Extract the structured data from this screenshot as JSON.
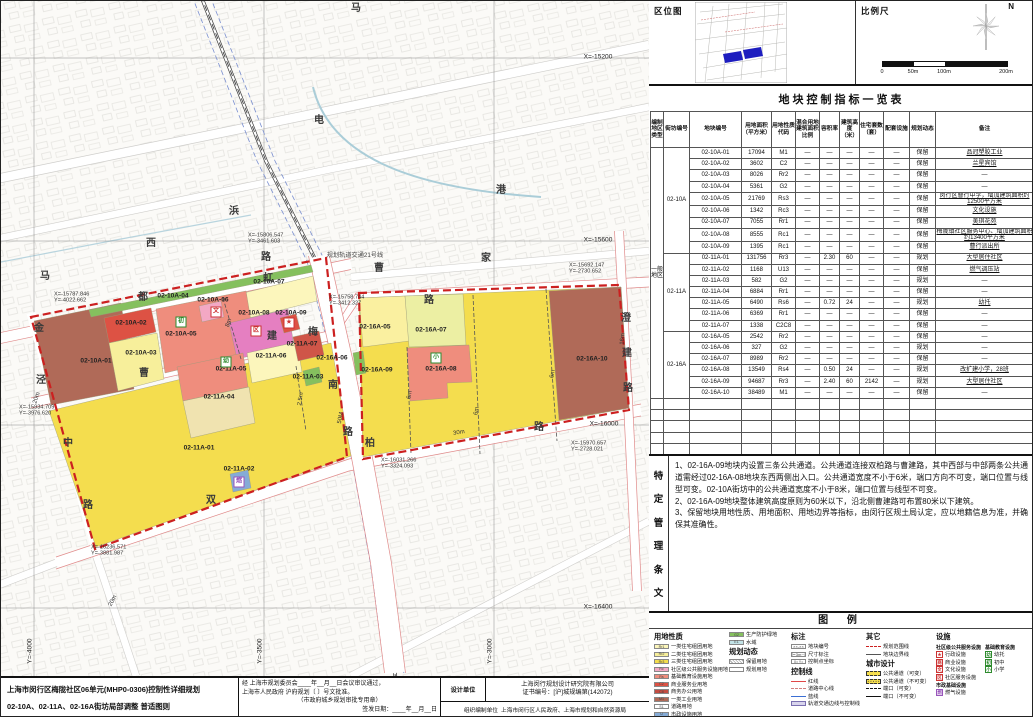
{
  "location_panel": {
    "title": "区位图"
  },
  "scale_panel": {
    "title": "比例尺",
    "north_label": "N",
    "ticks": [
      "0",
      "50m",
      "100m",
      "200m"
    ]
  },
  "table": {
    "title": "地块控制指标一览表",
    "headers": [
      "编制地区类型",
      "街坊编号",
      "地块编号",
      "用地面积（平方米）",
      "用地性质代码",
      "混合用地建筑面积比例",
      "容积率",
      "建筑高度（米）",
      "住宅套数（套）",
      "配套设施",
      "规划动态",
      "备注"
    ],
    "area_type": "一般地区",
    "groups": [
      {
        "block": "02-10A",
        "rows": [
          [
            "02-10A-01",
            "17094",
            "M1",
            "—",
            "—",
            "—",
            "—",
            "—",
            "保留",
            "品冠塑胶工业"
          ],
          [
            "02-10A-02",
            "3602",
            "C2",
            "—",
            "—",
            "—",
            "—",
            "—",
            "保留",
            "兰星宾馆"
          ],
          [
            "02-10A-03",
            "8026",
            "Rr2",
            "—",
            "—",
            "—",
            "—",
            "—",
            "保留",
            "—"
          ],
          [
            "02-10A-04",
            "5361",
            "G2",
            "—",
            "—",
            "—",
            "—",
            "—",
            "保留",
            "—"
          ],
          [
            "02-10A-05",
            "21769",
            "Rs3",
            "—",
            "—",
            "—",
            "—",
            "—",
            "保留",
            "闵行区曹行中学，增加建筑面积约12500平方米"
          ],
          [
            "02-10A-06",
            "1342",
            "Rc3",
            "—",
            "—",
            "—",
            "—",
            "—",
            "保留",
            "文化设施"
          ],
          [
            "02-10A-07",
            "7055",
            "Rr1",
            "—",
            "—",
            "—",
            "—",
            "—",
            "保留",
            "美琪花苑"
          ],
          [
            "02-10A-08",
            "8555",
            "Rc1",
            "—",
            "—",
            "—",
            "—",
            "—",
            "保留",
            "梅陇镇社区服务中心、增加建筑面积约13400平方米"
          ],
          [
            "02-10A-09",
            "1395",
            "Rc1",
            "—",
            "—",
            "—",
            "—",
            "—",
            "保留",
            "曹行派出所"
          ]
        ]
      },
      {
        "block": "02-11A",
        "rows": [
          [
            "02-11A-01",
            "131756",
            "Rr3",
            "—",
            "2.30",
            "60",
            "—",
            "—",
            "规划",
            "大型居住社区"
          ],
          [
            "02-11A-02",
            "1168",
            "U13",
            "—",
            "—",
            "—",
            "—",
            "—",
            "保留",
            "燃气调压站"
          ],
          [
            "02-11A-03",
            "582",
            "G2",
            "—",
            "—",
            "—",
            "—",
            "—",
            "规划",
            "—"
          ],
          [
            "02-11A-04",
            "6884",
            "Rr1",
            "—",
            "—",
            "—",
            "—",
            "—",
            "保留",
            "—"
          ],
          [
            "02-11A-05",
            "6490",
            "Rs6",
            "—",
            "0.72",
            "24",
            "—",
            "—",
            "规划",
            "幼托"
          ],
          [
            "02-11A-06",
            "6369",
            "Rr1",
            "—",
            "—",
            "—",
            "—",
            "—",
            "保留",
            "—"
          ],
          [
            "02-11A-07",
            "1338",
            "C2C8",
            "—",
            "—",
            "—",
            "—",
            "—",
            "保留",
            "—"
          ]
        ]
      },
      {
        "block": "02-16A",
        "rows": [
          [
            "02-16A-05",
            "2542",
            "Rr2",
            "—",
            "—",
            "—",
            "—",
            "—",
            "保留",
            "—"
          ],
          [
            "02-16A-06",
            "327",
            "G2",
            "—",
            "—",
            "—",
            "—",
            "—",
            "规划",
            "—"
          ],
          [
            "02-16A-07",
            "8989",
            "Rr2",
            "—",
            "—",
            "—",
            "—",
            "—",
            "保留",
            "—"
          ],
          [
            "02-16A-08",
            "13549",
            "Rs4",
            "—",
            "0.50",
            "24",
            "—",
            "—",
            "规划",
            "改扩建小学，28班"
          ],
          [
            "02-16A-09",
            "94687",
            "Rr3",
            "—",
            "2.40",
            "60",
            "2142",
            "—",
            "规划",
            "大型居住社区"
          ],
          [
            "02-16A-10",
            "38489",
            "M1",
            "—",
            "—",
            "—",
            "—",
            "—",
            "保留",
            "—"
          ]
        ]
      }
    ],
    "empty_row_count": 7
  },
  "special_provisions": {
    "side_label": "特定管理条文",
    "items": [
      "1、02-16A-09地块内设置三条公共通道。公共通道连接双柏路与曹建路，其中西部与中部两条公共通道需经过02-16A-08地块东西两侧出入口。公共通道宽度不小于6米，端口方向不可变，端口位置与线型可变。02-10A街坊中的公共通道宽度不小于8米，端口位置与线型不可变。",
      "2、02-16A-09地块整体建筑高度原则为60米以下，沿北侧曹建路可布置80米以下建筑。",
      "3、保留地块用地性质、用地面积、用地边界等指标，由闵行区规土局认定，应以地籍信息为准，并确保其准确性。"
    ]
  },
  "legend": {
    "title": "图 例",
    "land_use": {
      "heading": "用地性质",
      "items": [
        {
          "code": "Rr1",
          "label": "一类住宅组团用地",
          "color": "#fcf6bc"
        },
        {
          "code": "Rr2",
          "label": "二类住宅组团用地",
          "color": "#f7ef9b"
        },
        {
          "code": "Rr3",
          "label": "三类住宅组团用地",
          "color": "#f4dd4e"
        },
        {
          "code": "Rc",
          "label": "社区级公共服务设施用地",
          "color": "#f3a8c4"
        },
        {
          "code": "Rs",
          "label": "基础教育设施用地",
          "color": "#ef8d7d"
        },
        {
          "code": "C2",
          "label": "商业服务业用地",
          "color": "#dd5244"
        },
        {
          "code": "C8",
          "label": "商务办公用地",
          "color": "#c34c42"
        },
        {
          "code": "M1",
          "label": "一类工业用地",
          "color": "#b06a58"
        },
        {
          "code": "S1",
          "label": "道路用地",
          "color": "#ffffff"
        },
        {
          "code": "U",
          "label": "市政设施用地",
          "color": "#85abd6"
        }
      ]
    },
    "land_use_extra": [
      {
        "code": "G2",
        "label": "生产防护绿地",
        "color": "#85c05e"
      },
      {
        "code": "E1",
        "label": "水域",
        "color": "#c2e2e6"
      }
    ],
    "dynamics": {
      "heading": "规划动态",
      "items": [
        {
          "label": "保留用地",
          "swatch": "hatch"
        },
        {
          "label": "规划用地",
          "swatch": "plain"
        }
      ]
    },
    "marks": {
      "heading": "标注",
      "items": [
        {
          "label": "地块编号",
          "swatch": "plotno",
          "sample": "××-××"
        },
        {
          "label": "尺寸标注",
          "swatch": "dim",
          "sample": "⊢3m⊣"
        },
        {
          "label": "控制点坐标",
          "swatch": "coordpt",
          "sample": "X= Y="
        }
      ]
    },
    "control_lines": {
      "heading": "控制线",
      "items": [
        {
          "label": "红线",
          "swatch": "line-red"
        },
        {
          "label": "道路中心线",
          "swatch": "line-center"
        },
        {
          "label": "蓝线",
          "swatch": "line-blue"
        },
        {
          "label": "轨道交通边线与控制线",
          "swatch": "line-rail"
        }
      ]
    },
    "others": {
      "heading": "其它",
      "items": [
        {
          "label": "规划范围线",
          "swatch": "line-reddash"
        },
        {
          "label": "地块边界线",
          "swatch": "line-plain"
        }
      ]
    },
    "urban_design": {
      "heading": "城市设计",
      "items": [
        {
          "label": "公共通道（可变）",
          "swatch": "passage-var"
        },
        {
          "label": "公共通道（不可变）",
          "swatch": "passage-fix"
        },
        {
          "label": "端口（可变）",
          "swatch": "port-var"
        },
        {
          "label": "端口（不可变）",
          "swatch": "port-fix"
        }
      ]
    },
    "facilities": {
      "heading": "设施",
      "community": {
        "heading": "社区级公共服务设施",
        "items": [
          {
            "label": "行政设施",
            "glyph": "★",
            "color": "#cc3333"
          },
          {
            "label": "商业设施",
            "glyph": "商",
            "color": "#cc3333"
          },
          {
            "label": "文化设施",
            "glyph": "文",
            "color": "#cc3333"
          },
          {
            "label": "社区服务设施",
            "glyph": "区",
            "color": "#cc3333"
          }
        ]
      },
      "education": {
        "heading": "基础教育设施",
        "items": [
          {
            "label": "幼托",
            "glyph": "幼",
            "color": "#2e8b2e"
          },
          {
            "label": "初中",
            "glyph": "初",
            "color": "#2e8b2e"
          },
          {
            "label": "小学",
            "glyph": "小",
            "color": "#2e8b2e"
          }
        ]
      },
      "municipal": {
        "heading": "市政基础设施",
        "items": [
          {
            "label": "燃气设施",
            "glyph": "燃",
            "color": "#9955bb"
          }
        ]
      }
    }
  },
  "title_block": {
    "project_line1": "上海市闵行区梅陇社区06单元(MHP0-0306)控制性详细规划",
    "project_line2": "02-10A、02-11A、02-16A街坊局部调整  普适图则",
    "approval_line1": "经  上海市规划委员会____年__月__日会议审议通过，",
    "approval_line2": "上海市人民政府  沪府规划〔    〕号文批准。",
    "approval_seal": "（市政府城乡规划审批专用章）",
    "approval_date": "签发日期：____年__月__日",
    "design_unit_label": "设计单位",
    "design_unit": "上海闵行规划设计研究院有限公司",
    "cert": "证书编号：[沪]城规编第(142072)",
    "org_label": "组织编制单位",
    "org": "上海市闵行区人民政府、上海市规划和自然资源局"
  },
  "map": {
    "rail_label": "规划轨道交通21号线",
    "labels": [
      {
        "t": "02-10A-01",
        "x": 95,
        "y": 361,
        "cls": "plot"
      },
      {
        "t": "02-10A-02",
        "x": 130,
        "y": 323,
        "cls": "plot"
      },
      {
        "t": "02-10A-03",
        "x": 140,
        "y": 353,
        "cls": "plot"
      },
      {
        "t": "02-10A-04",
        "x": 172,
        "y": 296,
        "cls": "plot"
      },
      {
        "t": "02-10A-05",
        "x": 180,
        "y": 334,
        "cls": "plot"
      },
      {
        "t": "02-10A-06",
        "x": 212,
        "y": 300,
        "cls": "plot"
      },
      {
        "t": "02-10A-07",
        "x": 268,
        "y": 282,
        "cls": "plot"
      },
      {
        "t": "02-10A-08",
        "x": 253,
        "y": 313,
        "cls": "plot"
      },
      {
        "t": "02-10A-09",
        "x": 290,
        "y": 313,
        "cls": "plot"
      },
      {
        "t": "02-11A-01",
        "x": 198,
        "y": 448,
        "cls": "plot"
      },
      {
        "t": "02-11A-02",
        "x": 238,
        "y": 469,
        "cls": "plot"
      },
      {
        "t": "02-11A-03",
        "x": 307,
        "y": 377,
        "cls": "plot"
      },
      {
        "t": "02-11A-04",
        "x": 218,
        "y": 397,
        "cls": "plot"
      },
      {
        "t": "02-11A-05",
        "x": 230,
        "y": 369,
        "cls": "plot"
      },
      {
        "t": "02-11A-06",
        "x": 270,
        "y": 356,
        "cls": "plot"
      },
      {
        "t": "02-11A-07",
        "x": 301,
        "y": 344,
        "cls": "plot"
      },
      {
        "t": "02-16A-05",
        "x": 374,
        "y": 327,
        "cls": "plot"
      },
      {
        "t": "02-16A-06",
        "x": 331,
        "y": 358,
        "cls": "plot"
      },
      {
        "t": "02-16A-07",
        "x": 430,
        "y": 330,
        "cls": "plot"
      },
      {
        "t": "02-16A-08",
        "x": 440,
        "y": 369,
        "cls": "plot"
      },
      {
        "t": "02-16A-09",
        "x": 376,
        "y": 370,
        "cls": "plot"
      },
      {
        "t": "02-16A-10",
        "x": 591,
        "y": 359,
        "cls": "plot"
      },
      {
        "t": "金",
        "x": 38,
        "y": 328,
        "cls": "road"
      },
      {
        "t": "都",
        "x": 142,
        "y": 297,
        "cls": "road"
      },
      {
        "t": "曹",
        "x": 143,
        "y": 373,
        "cls": "road"
      },
      {
        "t": "建",
        "x": 271,
        "y": 336,
        "cls": "road"
      },
      {
        "t": "路",
        "x": 428,
        "y": 300,
        "cls": "road"
      },
      {
        "t": "虹",
        "x": 267,
        "y": 278,
        "cls": "road"
      },
      {
        "t": "梅",
        "x": 312,
        "y": 332,
        "cls": "road"
      },
      {
        "t": "南",
        "x": 332,
        "y": 385,
        "cls": "road"
      },
      {
        "t": "路",
        "x": 347,
        "y": 432,
        "cls": "road"
      },
      {
        "t": "双",
        "x": 210,
        "y": 500,
        "cls": "road"
      },
      {
        "t": "柏",
        "x": 369,
        "y": 443,
        "cls": "road"
      },
      {
        "t": "路",
        "x": 538,
        "y": 427,
        "cls": "road"
      },
      {
        "t": "澄",
        "x": 625,
        "y": 318,
        "cls": "road"
      },
      {
        "t": "建",
        "x": 626,
        "y": 353,
        "cls": "road"
      },
      {
        "t": "路",
        "x": 627,
        "y": 388,
        "cls": "road"
      },
      {
        "t": "中",
        "x": 67,
        "y": 443,
        "cls": "road"
      },
      {
        "t": "路",
        "x": 87,
        "y": 505,
        "cls": "road"
      },
      {
        "t": "马",
        "x": 355,
        "y": 8,
        "cls": "road"
      },
      {
        "t": "电",
        "x": 318,
        "y": 120,
        "cls": "road"
      },
      {
        "t": "浜",
        "x": 233,
        "y": 211,
        "cls": "road"
      },
      {
        "t": "西",
        "x": 150,
        "y": 243,
        "cls": "road"
      },
      {
        "t": "路",
        "x": 265,
        "y": 257,
        "cls": "road"
      },
      {
        "t": "马",
        "x": 44,
        "y": 276,
        "cls": "road"
      },
      {
        "t": "泾",
        "x": 40,
        "y": 380,
        "cls": "road"
      },
      {
        "t": "港",
        "x": 500,
        "y": 190,
        "cls": "road"
      },
      {
        "t": "家",
        "x": 485,
        "y": 258,
        "cls": "road"
      },
      {
        "t": "曹",
        "x": 378,
        "y": 268,
        "cls": "road"
      },
      {
        "t": "20m",
        "x": 36,
        "y": 397,
        "cls": "width",
        "rot": -72
      },
      {
        "t": "20m",
        "x": 112,
        "y": 600,
        "cls": "width",
        "rot": -62
      },
      {
        "t": "8m",
        "x": 228,
        "y": 322,
        "cls": "width",
        "rot": -72
      },
      {
        "t": "2.5m",
        "x": 300,
        "y": 398,
        "cls": "width",
        "rot": -80
      },
      {
        "t": "50M",
        "x": 340,
        "y": 417,
        "cls": "width",
        "rot": -78
      },
      {
        "t": "6m",
        "x": 409,
        "y": 394,
        "cls": "width",
        "rot": -80
      },
      {
        "t": "6m",
        "x": 476,
        "y": 410,
        "cls": "width",
        "rot": -80
      },
      {
        "t": "6m",
        "x": 552,
        "y": 373,
        "cls": "width",
        "rot": -80
      },
      {
        "t": "30m",
        "x": 458,
        "y": 432,
        "cls": "width",
        "rot": -10
      },
      {
        "t": "16m",
        "x": 622,
        "y": 338,
        "cls": "width",
        "rot": -85
      },
      {
        "t": "X=-15787.846\nY=-4022.662",
        "x": 53,
        "y": 297,
        "cls": "coord"
      },
      {
        "t": "X=-15806.547\nY=-3461.603",
        "x": 247,
        "y": 238,
        "cls": "coord"
      },
      {
        "t": "X=-15758.744\nY=-3412.327",
        "x": 328,
        "y": 300,
        "cls": "coord"
      },
      {
        "t": "X=-15692.147\nY=-2730.652",
        "x": 568,
        "y": 268,
        "cls": "coord"
      },
      {
        "t": "X=-15934.709\nY=-3976.620",
        "x": 18,
        "y": 410,
        "cls": "coord"
      },
      {
        "t": "X=-16236.571\nY=-3881.987",
        "x": 90,
        "y": 550,
        "cls": "coord"
      },
      {
        "t": "X=-16031.266\nY=-3324.093",
        "x": 380,
        "y": 463,
        "cls": "coord"
      },
      {
        "t": "X=-15970.657\nY=-2728.021",
        "x": 570,
        "y": 446,
        "cls": "coord"
      },
      {
        "t": "X=-15200",
        "x": 597,
        "y": 57,
        "cls": "grid"
      },
      {
        "t": "X=-15600",
        "x": 597,
        "y": 240,
        "cls": "grid"
      },
      {
        "t": "X=-16000",
        "x": 603,
        "y": 424,
        "cls": "grid"
      },
      {
        "t": "X=-16400",
        "x": 597,
        "y": 607,
        "cls": "grid"
      },
      {
        "t": "Y=-4000",
        "x": 30,
        "y": 650,
        "cls": "grid",
        "rot": -90
      },
      {
        "t": "Y=-3500",
        "x": 260,
        "y": 650,
        "cls": "grid",
        "rot": -90
      },
      {
        "t": "Y=-3000",
        "x": 490,
        "y": 650,
        "cls": "grid",
        "rot": -90
      },
      {
        "t": "规划轨道交通21号线",
        "x": 354,
        "y": 255,
        "cls": "rail"
      }
    ],
    "icons": [
      {
        "g": "初",
        "c": "#2e8b2e",
        "x": 180,
        "y": 321
      },
      {
        "g": "文",
        "c": "#cc3333",
        "x": 215,
        "y": 311
      },
      {
        "g": "区",
        "c": "#cc3333",
        "x": 255,
        "y": 330
      },
      {
        "g": "★",
        "c": "#cc3333",
        "x": 288,
        "y": 322
      },
      {
        "g": "幼",
        "c": "#2e8b2e",
        "x": 225,
        "y": 361
      },
      {
        "g": "燃",
        "c": "#9955bb",
        "x": 238,
        "y": 481
      },
      {
        "g": "小",
        "c": "#2e8b2e",
        "x": 435,
        "y": 357
      }
    ]
  }
}
